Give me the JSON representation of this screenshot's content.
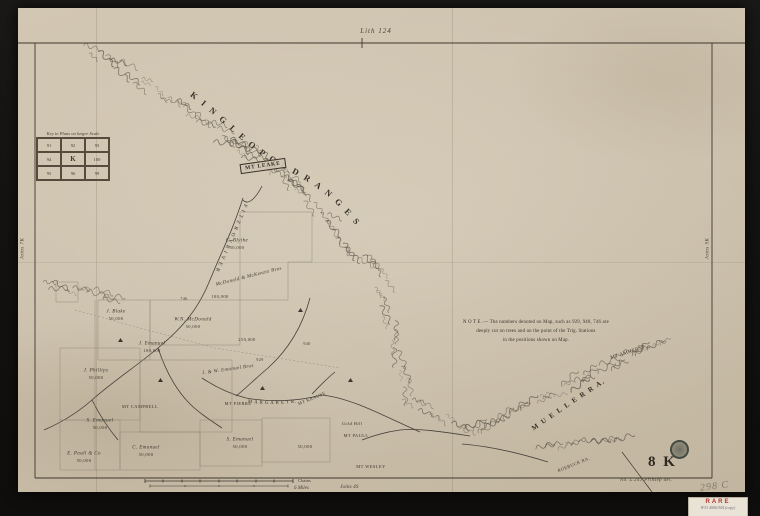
{
  "header": {
    "lith": "Lith 124"
  },
  "ranges": {
    "king_leopold": "K I N G   L E O P O L D   R A N G E S",
    "mueller": "M U E L L E R   R A.",
    "fitzroy": "F I T Z R O Y   R I V E R",
    "margaret": "M A R G A R E T   R.",
    "mt_leake": "MT LEAKE"
  },
  "note": {
    "line1": "N O T E .— The numbers denoted on Map, such as 929, 940, 746 are",
    "line2": "deeply cut on trees and on the point of the Trig. Stations",
    "line3": "in the positions shown on Map."
  },
  "key_grid": {
    "title": "Key to Plans on larger Scale",
    "rows": [
      [
        "91",
        "92",
        "93"
      ],
      [
        "94",
        "K",
        "100"
      ],
      [
        "95",
        "96",
        "99"
      ]
    ]
  },
  "edges": {
    "left": "Joins 7K",
    "right": "Joins 9K",
    "bottom": "Joins 4S"
  },
  "scale": {
    "chains": "Chains",
    "miles": "6 Miles"
  },
  "sheet": {
    "id": "8 K",
    "imprint": "No.  L.241  Prinsep del.",
    "pencil": "298 C"
  },
  "label_tag": {
    "title": "RARE",
    "note": "W33 4000/304 (copy)"
  },
  "colors": {
    "ink": "#3e372d",
    "paper": "#ccc1ad",
    "stamp": "#2a342e",
    "rare_red": "#b5372f"
  },
  "map_labels": [
    {
      "text": "C. Blythe",
      "x": 237,
      "y": 241,
      "s": 5,
      "i": 1
    },
    {
      "text": "50,000",
      "x": 237,
      "y": 248,
      "s": 4.5
    },
    {
      "text": "McDonald & McKenzie Bros",
      "x": 249,
      "y": 277,
      "r": -14,
      "s": 5,
      "i": 1
    },
    {
      "text": "100,000",
      "x": 220,
      "y": 297,
      "s": 4.5
    },
    {
      "text": "W.N. McDonald",
      "x": 193,
      "y": 320,
      "s": 5,
      "i": 1
    },
    {
      "text": "50,000",
      "x": 193,
      "y": 327,
      "s": 4.5
    },
    {
      "text": "J. Blake",
      "x": 116,
      "y": 312,
      "s": 5,
      "i": 1
    },
    {
      "text": "50,000",
      "x": 116,
      "y": 319,
      "s": 4.5
    },
    {
      "text": "J. Emanuel",
      "x": 152,
      "y": 344,
      "s": 5,
      "i": 1
    },
    {
      "text": "100,000",
      "x": 152,
      "y": 351,
      "s": 4.5
    },
    {
      "text": "250,000",
      "x": 247,
      "y": 340,
      "s": 4.5
    },
    {
      "text": "J. Phillips",
      "x": 96,
      "y": 371,
      "s": 5,
      "i": 1
    },
    {
      "text": "50,000",
      "x": 96,
      "y": 378,
      "s": 4.5
    },
    {
      "text": "S. Emanuel",
      "x": 100,
      "y": 421,
      "s": 5,
      "i": 1
    },
    {
      "text": "50,000",
      "x": 100,
      "y": 428,
      "s": 4.5
    },
    {
      "text": "C. Emanuel",
      "x": 146,
      "y": 448,
      "s": 5,
      "i": 1
    },
    {
      "text": "50,000",
      "x": 146,
      "y": 455,
      "s": 4.5
    },
    {
      "text": "E. Paull & Co",
      "x": 84,
      "y": 454,
      "s": 5,
      "i": 1
    },
    {
      "text": "50,000",
      "x": 84,
      "y": 461,
      "s": 4.5
    },
    {
      "text": "J. & W. Emanuel Bros",
      "x": 228,
      "y": 370,
      "r": -8,
      "s": 5,
      "i": 1
    },
    {
      "text": "S. Emanuel",
      "x": 240,
      "y": 440,
      "s": 5,
      "i": 1
    },
    {
      "text": "50,000",
      "x": 240,
      "y": 447,
      "s": 4.5
    },
    {
      "text": "50,000",
      "x": 305,
      "y": 447,
      "s": 4.5
    },
    {
      "text": "MT CAMPBELL",
      "x": 140,
      "y": 407,
      "s": 4.5
    },
    {
      "text": "MT PIERRE",
      "x": 238,
      "y": 404,
      "s": 4.5
    },
    {
      "text": "MT KRAUSE",
      "x": 312,
      "y": 399,
      "r": -22,
      "s": 4.5
    },
    {
      "text": "Gold Hill",
      "x": 352,
      "y": 424,
      "s": 4.5,
      "i": 1
    },
    {
      "text": "MT PAULL",
      "x": 356,
      "y": 436,
      "s": 4.5
    },
    {
      "text": "MT WESLEY",
      "x": 371,
      "y": 467,
      "s": 4.5
    },
    {
      "text": "929",
      "x": 260,
      "y": 360,
      "s": 4
    },
    {
      "text": "940",
      "x": 307,
      "y": 344,
      "s": 4
    },
    {
      "text": "746",
      "x": 184,
      "y": 299,
      "s": 4
    },
    {
      "text": "MT AMHERST",
      "x": 628,
      "y": 353,
      "r": -18,
      "s": 5
    },
    {
      "text": "ROEBUCK RA.",
      "x": 574,
      "y": 465,
      "r": -22,
      "s": 4.5
    }
  ]
}
